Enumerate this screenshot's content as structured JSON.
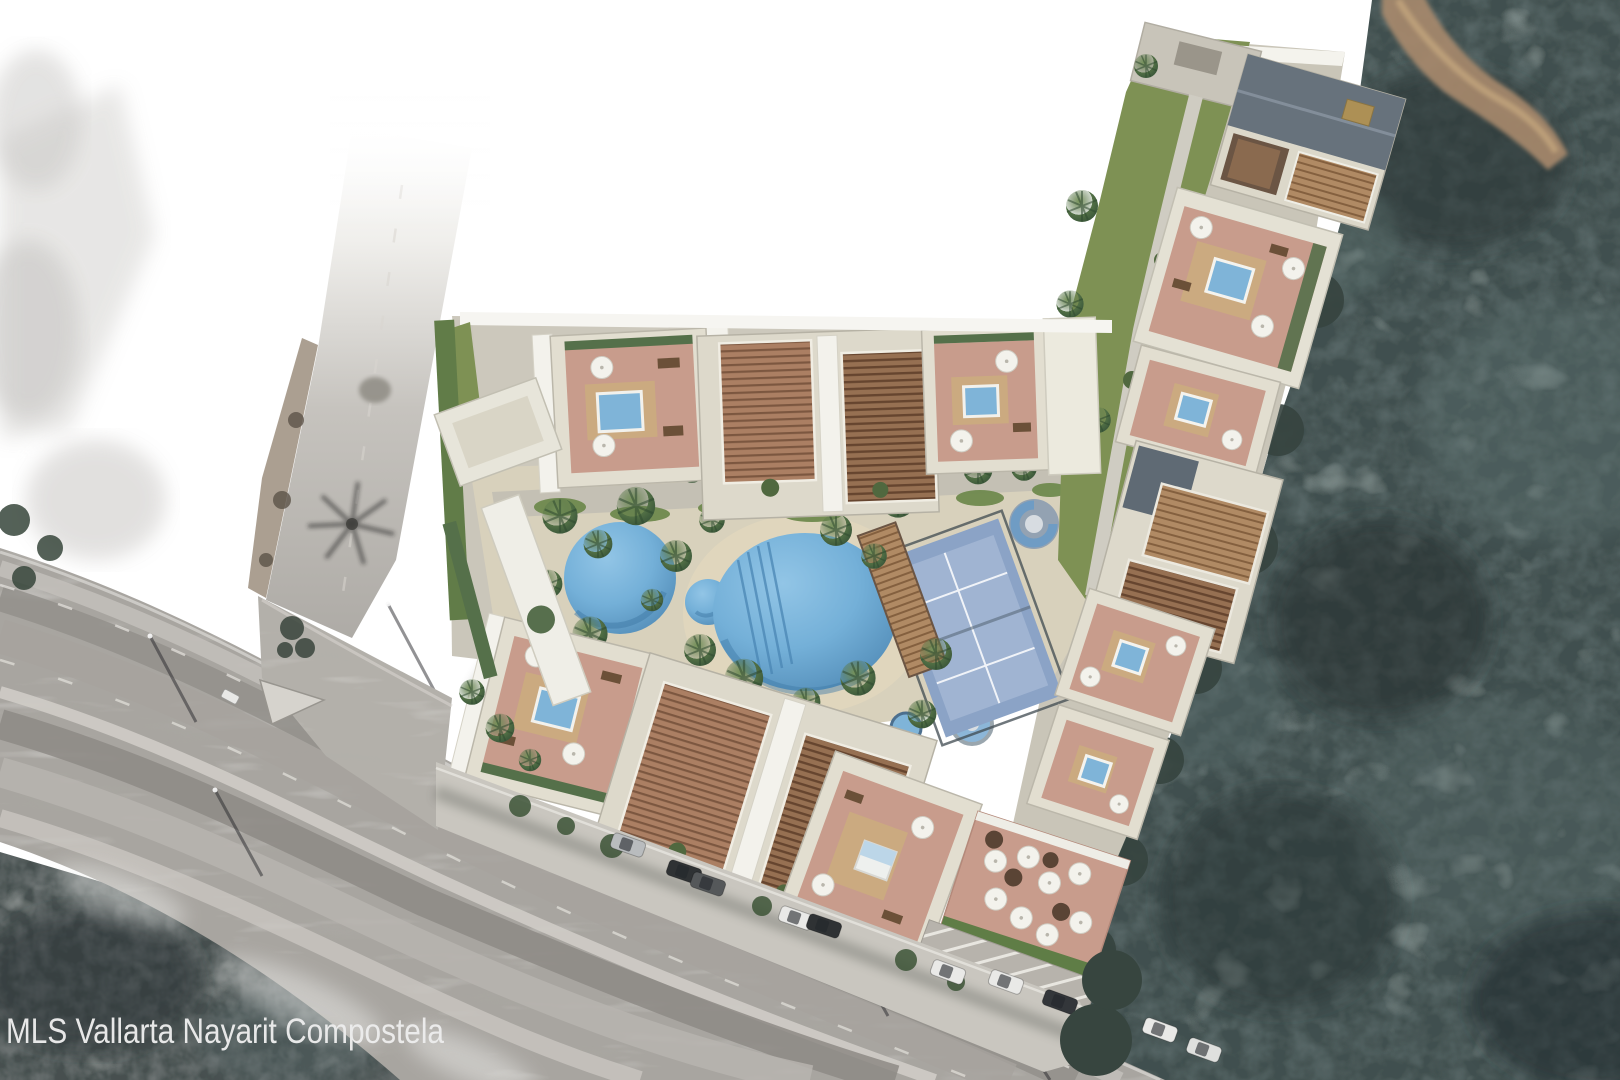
{
  "watermark": {
    "text": "MLS Vallarta Nayarit Compostela"
  },
  "scene": {
    "type": "aerial-site-plan-render",
    "areas": {
      "forest": "dense-tree-canopy-right",
      "highway": "multi-lane-road-lower-left",
      "entry_road": "access-road-top-left",
      "development": "l-shaped-condo-complex-rooftop-terraces",
      "amenity_courtyard": "pools-palms-paddle-court",
      "street_parking": "cars-along-internal-street"
    },
    "counts": {
      "round_pools": 2,
      "kids_pool": 1,
      "spa_circles": 3,
      "sport_courts": 1,
      "parked_cars": 10,
      "rooftop_plunge_pools": 7
    }
  },
  "palette": {
    "page-bg": "#ffffff",
    "watermark": "#ededed",
    "forest": "#41504f",
    "forest-dark": "#232c2d",
    "forest-light": "#647876",
    "veg": "#46504f",
    "road": "#a8a5a0",
    "road-light": "#c9c6c1",
    "road-dark": "#8d8a85",
    "lawn": "#7e9154",
    "hedge": "#55704a",
    "paving": "#cdc9bf",
    "sand": "#d8d1bc",
    "building": "#ddd9cb",
    "building-white": "#f3f2ec",
    "terrace": "#c89c8c",
    "deck": "#cbaa80",
    "pergola": "#967052",
    "slate-roof": "#67727c",
    "pool": "#74b0d8",
    "court": "#8ba3c6",
    "court-light": "#a0b4d2",
    "car-dark": "#2f3234",
    "car-white": "#e9e9e7",
    "umbrella": "#f3f2ec",
    "dirt-path": "#a98a6d"
  }
}
